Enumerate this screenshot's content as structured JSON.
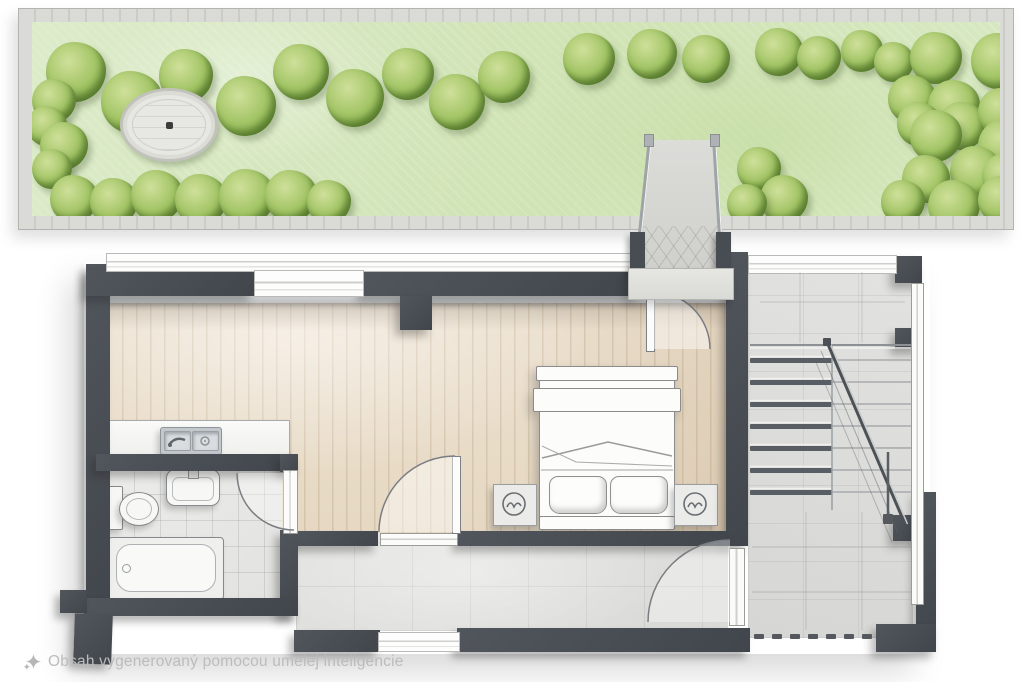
{
  "watermark": {
    "icon": "ai-sparkle-icon",
    "text": "Obsah vygenerovaný pomocou umelej inteligencie"
  },
  "palette": {
    "wall": "#474c52",
    "wood_floor": "#e9decb",
    "tile_floor": "#e9e9e7",
    "concrete": "#dedede",
    "grass": "#d5e6bb",
    "bush_green": "#9dc060",
    "paver_gray": "#d6d6d2",
    "fixture_white": "#f7f7f5"
  },
  "garden": {
    "plaza": {
      "cx": 134,
      "cy": 100,
      "rx": 46,
      "ry": 34
    },
    "bushes": [
      [
        44,
        50,
        30
      ],
      [
        100,
        80,
        31
      ],
      [
        154,
        54,
        27
      ],
      [
        214,
        84,
        30
      ],
      [
        269,
        50,
        28
      ],
      [
        323,
        76,
        29
      ],
      [
        376,
        52,
        26
      ],
      [
        425,
        80,
        28
      ],
      [
        472,
        55,
        26
      ],
      [
        557,
        37,
        26
      ],
      [
        620,
        32,
        25
      ],
      [
        674,
        37,
        24
      ],
      [
        747,
        30,
        24
      ],
      [
        787,
        36,
        22
      ],
      [
        830,
        29,
        21
      ],
      [
        862,
        40,
        20
      ],
      [
        904,
        36,
        26
      ],
      [
        967,
        39,
        28
      ],
      [
        22,
        79,
        22
      ],
      [
        15,
        104,
        20
      ],
      [
        32,
        124,
        24
      ],
      [
        20,
        147,
        20
      ],
      [
        42,
        177,
        24
      ],
      [
        82,
        180,
        24
      ],
      [
        125,
        174,
        26
      ],
      [
        169,
        178,
        26
      ],
      [
        215,
        175,
        28
      ],
      [
        259,
        174,
        26
      ],
      [
        297,
        180,
        22
      ],
      [
        880,
        77,
        24
      ],
      [
        922,
        84,
        26
      ],
      [
        887,
        102,
        22
      ],
      [
        930,
        104,
        24
      ],
      [
        970,
        90,
        24
      ],
      [
        904,
        114,
        26
      ],
      [
        972,
        124,
        26
      ],
      [
        944,
        150,
        26
      ],
      [
        894,
        157,
        24
      ],
      [
        972,
        154,
        22
      ],
      [
        871,
        180,
        22
      ],
      [
        922,
        184,
        26
      ],
      [
        970,
        178,
        24
      ],
      [
        727,
        147,
        22
      ],
      [
        752,
        177,
        24
      ],
      [
        715,
        182,
        20
      ]
    ]
  },
  "stairs": {
    "left_treads": {
      "x": 750,
      "width": 82,
      "y_start": 358,
      "step": 22,
      "count": 7
    },
    "full_lines": {
      "x1": 832,
      "x2": 911
    },
    "divider_x": 832,
    "landing_edge_y": 345,
    "railing": {
      "x1": 827,
      "y1": 342,
      "x2": 905,
      "y2": 524
    },
    "post": {
      "x": 888,
      "y1": 452,
      "y2": 518
    }
  },
  "terrace": {
    "dashes": {
      "y": 634,
      "x0": 754,
      "step": 18,
      "count": 7,
      "w": 10,
      "h": 5
    }
  }
}
